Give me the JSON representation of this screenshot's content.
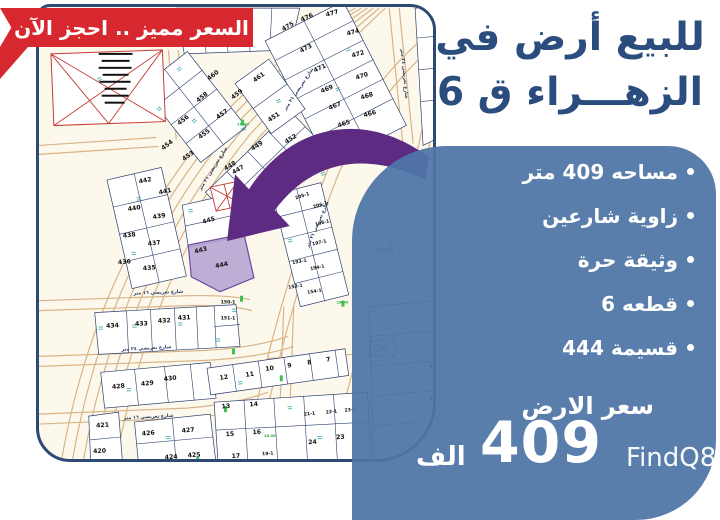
{
  "banner": {
    "text": "السعر مميز .. احجز الآن"
  },
  "headline": {
    "line1": "للبيع أرض في",
    "line2": "الزهـــراء ق 6"
  },
  "details": {
    "bullets": [
      "مساحه 409 متر",
      "زاوية شارعين",
      "وثيقة حرة",
      "قطعه 6",
      "قسيمة 444"
    ],
    "price_label": "سعر الارض",
    "price_value": "409",
    "price_unit": "الف"
  },
  "watermark": "FindQ8",
  "colors": {
    "banner_red": "#d7282f",
    "headline_blue": "#2a4d7e",
    "panel_blue": "#4e75a6",
    "map_border": "#2c4a74",
    "arrow_purple": "#5e2b82",
    "highlight_fill": "#b3a0d0"
  },
  "map": {
    "highlight_plot": "444",
    "area_label": "الزهراء",
    "plots": [
      {
        "n": "477",
        "x": 295,
        "y": 7,
        "r": -15
      },
      {
        "n": "476",
        "x": 270,
        "y": 11,
        "r": -24
      },
      {
        "n": "475",
        "x": 251,
        "y": 20,
        "r": -30
      },
      {
        "n": "474",
        "x": 316,
        "y": 26,
        "r": -15
      },
      {
        "n": "473",
        "x": 269,
        "y": 42,
        "r": -27
      },
      {
        "n": "472",
        "x": 321,
        "y": 48,
        "r": -16
      },
      {
        "n": "471",
        "x": 283,
        "y": 62,
        "r": -25
      },
      {
        "n": "470",
        "x": 325,
        "y": 70,
        "r": -17
      },
      {
        "n": "469",
        "x": 290,
        "y": 83,
        "r": -23
      },
      {
        "n": "468",
        "x": 330,
        "y": 90,
        "r": -17
      },
      {
        "n": "467",
        "x": 298,
        "y": 100,
        "r": -21
      },
      {
        "n": "466",
        "x": 333,
        "y": 108,
        "r": -15
      },
      {
        "n": "465",
        "x": 307,
        "y": 118,
        "r": -19
      },
      {
        "n": "464",
        "x": 349,
        "y": 136,
        "r": -12
      },
      {
        "n": "461",
        "x": 222,
        "y": 71,
        "r": -36
      },
      {
        "n": "460",
        "x": 176,
        "y": 69,
        "r": -38
      },
      {
        "n": "459",
        "x": 200,
        "y": 88,
        "r": -38
      },
      {
        "n": "458",
        "x": 165,
        "y": 91,
        "r": -38
      },
      {
        "n": "457",
        "x": 185,
        "y": 108,
        "r": -36
      },
      {
        "n": "456",
        "x": 146,
        "y": 114,
        "r": -38
      },
      {
        "n": "455",
        "x": 167,
        "y": 128,
        "r": -36
      },
      {
        "n": "454",
        "x": 130,
        "y": 139,
        "r": -38
      },
      {
        "n": "453",
        "x": 151,
        "y": 150,
        "r": -36
      },
      {
        "n": "451",
        "x": 237,
        "y": 111,
        "r": -34
      },
      {
        "n": "452",
        "x": 254,
        "y": 133,
        "r": -32
      },
      {
        "n": "449",
        "x": 220,
        "y": 140,
        "r": -32
      },
      {
        "n": "450",
        "x": 251,
        "y": 154,
        "r": -30
      },
      {
        "n": "448",
        "x": 193,
        "y": 160,
        "r": -32
      },
      {
        "n": "447",
        "x": 201,
        "y": 164,
        "r": -30
      },
      {
        "n": "446",
        "x": 229,
        "y": 175,
        "r": -28
      },
      {
        "n": "445",
        "x": 171,
        "y": 215,
        "r": -16
      },
      {
        "n": "443",
        "x": 163,
        "y": 245,
        "r": -14
      },
      {
        "n": "444",
        "x": 184,
        "y": 260,
        "r": -12
      },
      {
        "n": "442",
        "x": 107,
        "y": 175,
        "r": -11
      },
      {
        "n": "441",
        "x": 127,
        "y": 186,
        "r": -11
      },
      {
        "n": "440",
        "x": 96,
        "y": 203,
        "r": -9
      },
      {
        "n": "439",
        "x": 121,
        "y": 211,
        "r": -9
      },
      {
        "n": "438",
        "x": 91,
        "y": 230,
        "r": -7
      },
      {
        "n": "437",
        "x": 116,
        "y": 238,
        "r": -7
      },
      {
        "n": "436",
        "x": 86,
        "y": 257,
        "r": -5
      },
      {
        "n": "435",
        "x": 111,
        "y": 263,
        "r": -5
      },
      {
        "n": "205-1",
        "x": 265,
        "y": 190,
        "r": -18,
        "c": "sm"
      },
      {
        "n": "206-1",
        "x": 283,
        "y": 199,
        "r": -18,
        "c": "sm"
      },
      {
        "n": "196-1",
        "x": 285,
        "y": 217,
        "r": -15,
        "c": "sm"
      },
      {
        "n": "197-1",
        "x": 282,
        "y": 237,
        "r": -13,
        "c": "sm"
      },
      {
        "n": "193-1",
        "x": 262,
        "y": 256,
        "r": -11,
        "c": "sm"
      },
      {
        "n": "194-1",
        "x": 280,
        "y": 262,
        "r": -11,
        "c": "sm"
      },
      {
        "n": "153-1",
        "x": 258,
        "y": 281,
        "r": -9,
        "c": "sm"
      },
      {
        "n": "154-1",
        "x": 277,
        "y": 286,
        "r": -9,
        "c": "sm"
      },
      {
        "n": "434",
        "x": 74,
        "y": 321,
        "r": -3
      },
      {
        "n": "433",
        "x": 103,
        "y": 319,
        "r": -3
      },
      {
        "n": "432",
        "x": 126,
        "y": 316,
        "r": -3
      },
      {
        "n": "431",
        "x": 146,
        "y": 313,
        "r": -3
      },
      {
        "n": "150-1",
        "x": 190,
        "y": 297,
        "r": 0,
        "c": "sm"
      },
      {
        "n": "151-1",
        "x": 190,
        "y": 313,
        "r": 0,
        "c": "sm"
      },
      {
        "n": "428",
        "x": 80,
        "y": 382,
        "r": -6
      },
      {
        "n": "429",
        "x": 109,
        "y": 379,
        "r": -6
      },
      {
        "n": "430",
        "x": 132,
        "y": 374,
        "r": -6
      },
      {
        "n": "421",
        "x": 64,
        "y": 421,
        "r": -4
      },
      {
        "n": "420",
        "x": 61,
        "y": 447,
        "r": -3
      },
      {
        "n": "426",
        "x": 110,
        "y": 429,
        "r": -5
      },
      {
        "n": "427",
        "x": 150,
        "y": 426,
        "r": -5
      },
      {
        "n": "424",
        "x": 133,
        "y": 453,
        "r": -4
      },
      {
        "n": "425",
        "x": 156,
        "y": 451,
        "r": -4
      },
      {
        "n": "12",
        "x": 186,
        "y": 373,
        "r": -8
      },
      {
        "n": "11",
        "x": 212,
        "y": 370,
        "r": -8
      },
      {
        "n": "10",
        "x": 232,
        "y": 364,
        "r": -8
      },
      {
        "n": "9",
        "x": 252,
        "y": 361,
        "r": -8
      },
      {
        "n": "8",
        "x": 272,
        "y": 358,
        "r": -8
      },
      {
        "n": "7",
        "x": 291,
        "y": 355,
        "r": -8
      },
      {
        "n": "13",
        "x": 188,
        "y": 402,
        "r": -5
      },
      {
        "n": "14",
        "x": 216,
        "y": 400,
        "r": -5
      },
      {
        "n": "15",
        "x": 192,
        "y": 430,
        "r": -4
      },
      {
        "n": "16",
        "x": 219,
        "y": 428,
        "r": -4
      },
      {
        "n": "17",
        "x": 198,
        "y": 452,
        "r": -3
      },
      {
        "n": "21-1",
        "x": 272,
        "y": 409,
        "r": -6,
        "c": "sm"
      },
      {
        "n": "22-1",
        "x": 294,
        "y": 407,
        "r": -6,
        "c": "sm"
      },
      {
        "n": "23-1",
        "x": 313,
        "y": 405,
        "r": -6,
        "c": "sm"
      },
      {
        "n": "19-1",
        "x": 230,
        "y": 449,
        "r": -4,
        "c": "sm"
      },
      {
        "n": "24",
        "x": 275,
        "y": 438,
        "r": -4
      },
      {
        "n": "23",
        "x": 303,
        "y": 433,
        "r": -4
      },
      {
        "n": "5",
        "x": 394,
        "y": 362,
        "r": 0,
        "c": "sm"
      },
      {
        "n": "4",
        "x": 394,
        "y": 394,
        "r": 0,
        "c": "sm"
      }
    ],
    "street_labels": [
      {
        "t": "شارع تعريضي ٢١ متر",
        "x": 176,
        "y": 162,
        "r": -58
      },
      {
        "t": "شارع تعريضي ٢١ متر",
        "x": 262,
        "y": 82,
        "r": -56
      },
      {
        "t": "شارع تعريضي ٢٤ متر",
        "x": 366,
        "y": 66,
        "r": 85
      },
      {
        "t": "شارع تعريضي ١٦ متر",
        "x": 120,
        "y": 287,
        "r": -2
      },
      {
        "t": "شارع تعريضي ٢٤ متر",
        "x": 108,
        "y": 343,
        "r": -3
      },
      {
        "t": "شارع تعريضي ١٦ متر",
        "x": 110,
        "y": 412,
        "r": -3
      },
      {
        "t": "شارع تعريضي ٢١ متر",
        "x": 281,
        "y": 218,
        "r": -66
      }
    ],
    "measure_labels": [
      {
        "t": "16.00",
        "x": 232,
        "y": 431
      },
      {
        "t": "18.00",
        "x": 305,
        "y": 297
      },
      {
        "t": "16.00",
        "x": 205,
        "y": 118
      }
    ]
  }
}
